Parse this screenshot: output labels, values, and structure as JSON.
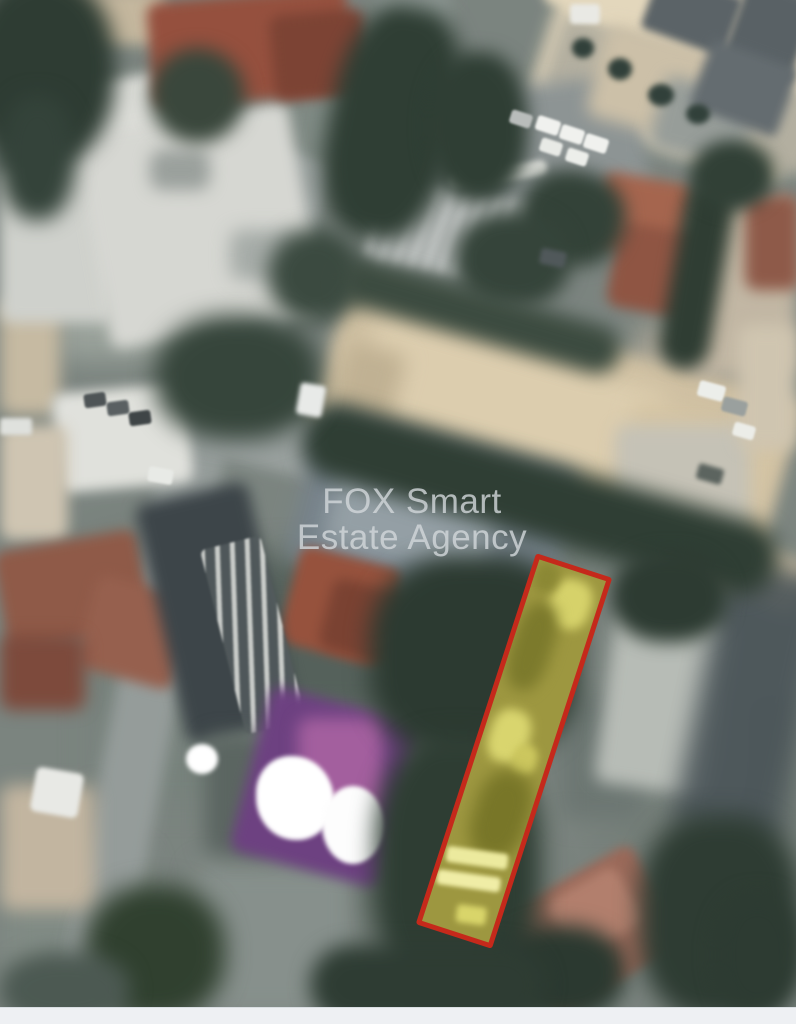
{
  "page": {
    "bottom_strip_color": "#eef0f3"
  },
  "watermark": {
    "line1": "FOX Smart",
    "line2": "Estate Agency",
    "color": "#d3d8db",
    "opacity": 0.8
  },
  "map": {
    "type": "satellite-aerial-photo",
    "highlighted_plot": {
      "border_color": "#c5291b",
      "fill_color": "#9d9740"
    }
  }
}
